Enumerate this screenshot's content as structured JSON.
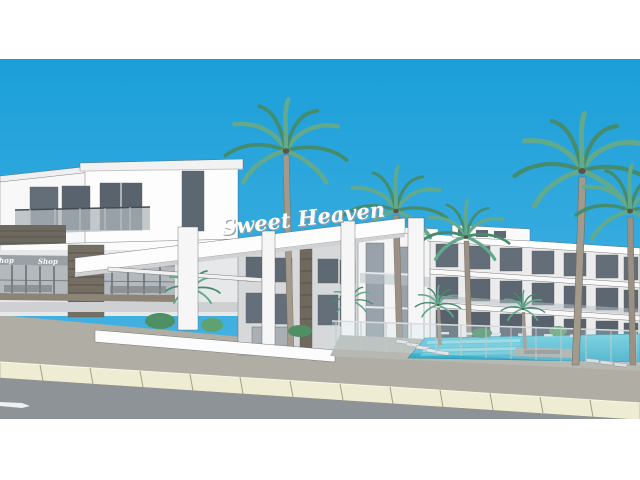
{
  "scene": {
    "description": "3D architectural rendering of a modern white resort apartment complex named Sweet Heaven, with entrance canopy, ground-floor shops, swimming pool with sun loungers, tall palm trees, and a street with curb in front; image letterboxed with white bands top and bottom",
    "signs": {
      "main": "Sweet Heaven",
      "shop": "Shop"
    },
    "colors": {
      "sky_top": "#1b9fd9",
      "sky_bottom": "#4ab4e2",
      "wall_white": "#fdfdfd",
      "wall_gray": "#d6d8d9",
      "window_glass": "#646e79",
      "stone": "#756e62",
      "palm_light": "#63a98c",
      "palm_dark": "#458c6f",
      "trunk": "#a39a8b",
      "pool_water": "#49c0d6",
      "pool_steps": "#8fd9e2",
      "deck": "#b7b8b2",
      "sidewalk": "#b0aea4",
      "curb": "#efecd4",
      "road": "#8e9397",
      "road_arrow": "#eef0f1",
      "letterbox": "#ffffff"
    }
  }
}
